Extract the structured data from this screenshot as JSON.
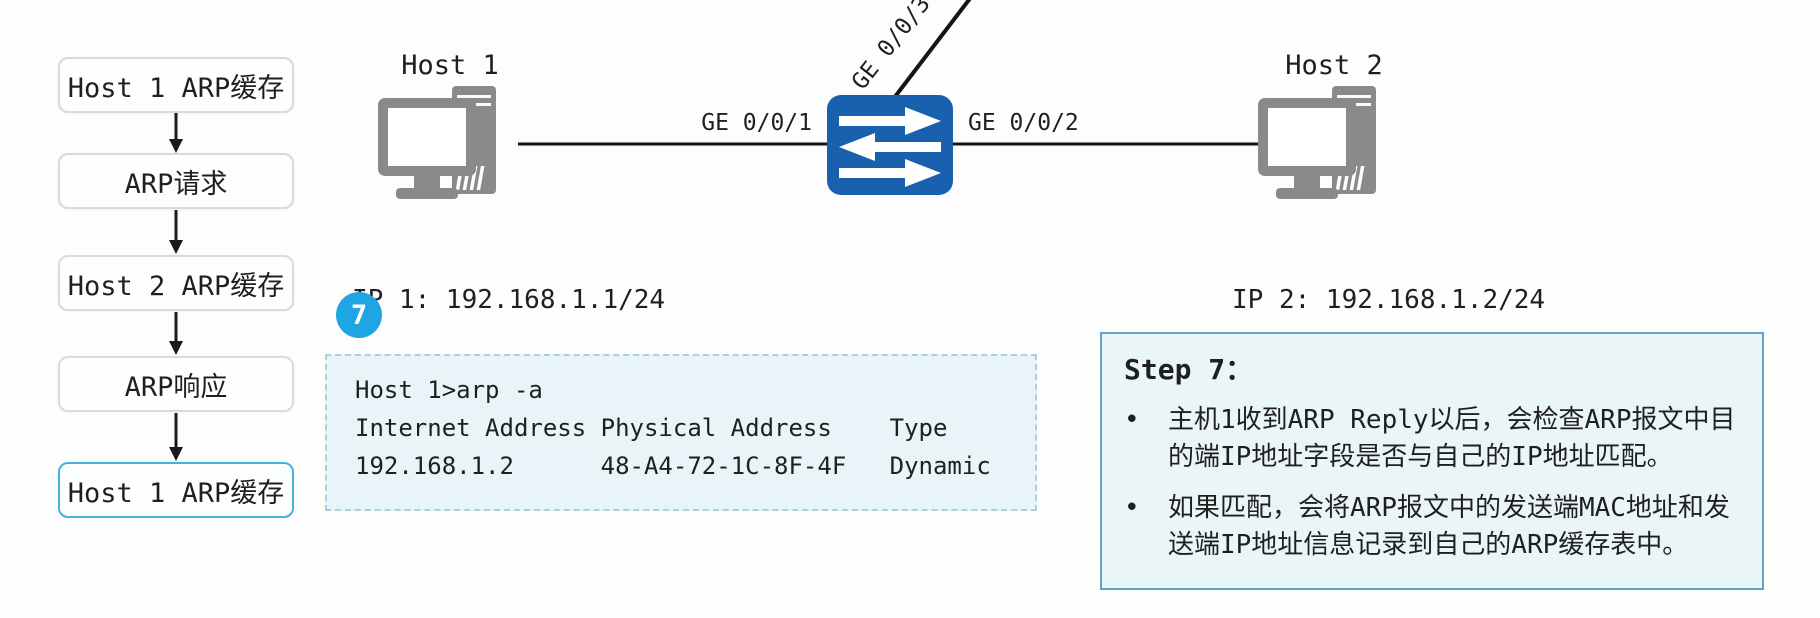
{
  "flowchart": {
    "steps": [
      {
        "label": "Host 1 ARP缓存",
        "highlighted": false
      },
      {
        "label": "ARP请求",
        "highlighted": false
      },
      {
        "label": "Host 2 ARP缓存",
        "highlighted": false
      },
      {
        "label": "ARP响应",
        "highlighted": false
      },
      {
        "label": "Host 1 ARP缓存",
        "highlighted": true
      }
    ]
  },
  "topology": {
    "host1": {
      "name": "Host 1",
      "ip_label": "IP 1: 192.168.1.1/24",
      "mac_label": "MAC 1: 3C-52-82-49-7E-9D"
    },
    "host2": {
      "name": "Host 2",
      "ip_label": "IP 2: 192.168.1.2/24",
      "mac_label": "MAC 2: 48-A4-72-1C-8F-4F"
    },
    "switch": {
      "port_left": "GE 0/0/1",
      "port_right": "GE 0/0/2",
      "port_top": "GE 0/0/3"
    }
  },
  "step_badge": "7",
  "terminal": {
    "lines": [
      "Host 1>arp -a",
      "Internet Address Physical Address    Type",
      "192.168.1.2      48-A4-72-1C-8F-4F   Dynamic"
    ]
  },
  "step_panel": {
    "title": "Step 7：",
    "bullet_char": "•",
    "bullets": [
      "主机1收到ARP Reply以后，会检查ARP报文中目的端IP地址字段是否与自己的IP地址匹配。",
      "如果匹配，会将ARP报文中的发送端MAC地址和发送端IP地址信息记录到自己的ARP缓存表中。"
    ]
  },
  "colors": {
    "switch_blue": "#1961ae",
    "badge_blue": "#1fa5e4",
    "highlight_border": "#43b3da",
    "panel_border": "#5ea5c6",
    "panel_bg": "#eaf5f8",
    "terminal_bg": "#e9f4f8",
    "icon_gray": "#8a8a8a"
  }
}
